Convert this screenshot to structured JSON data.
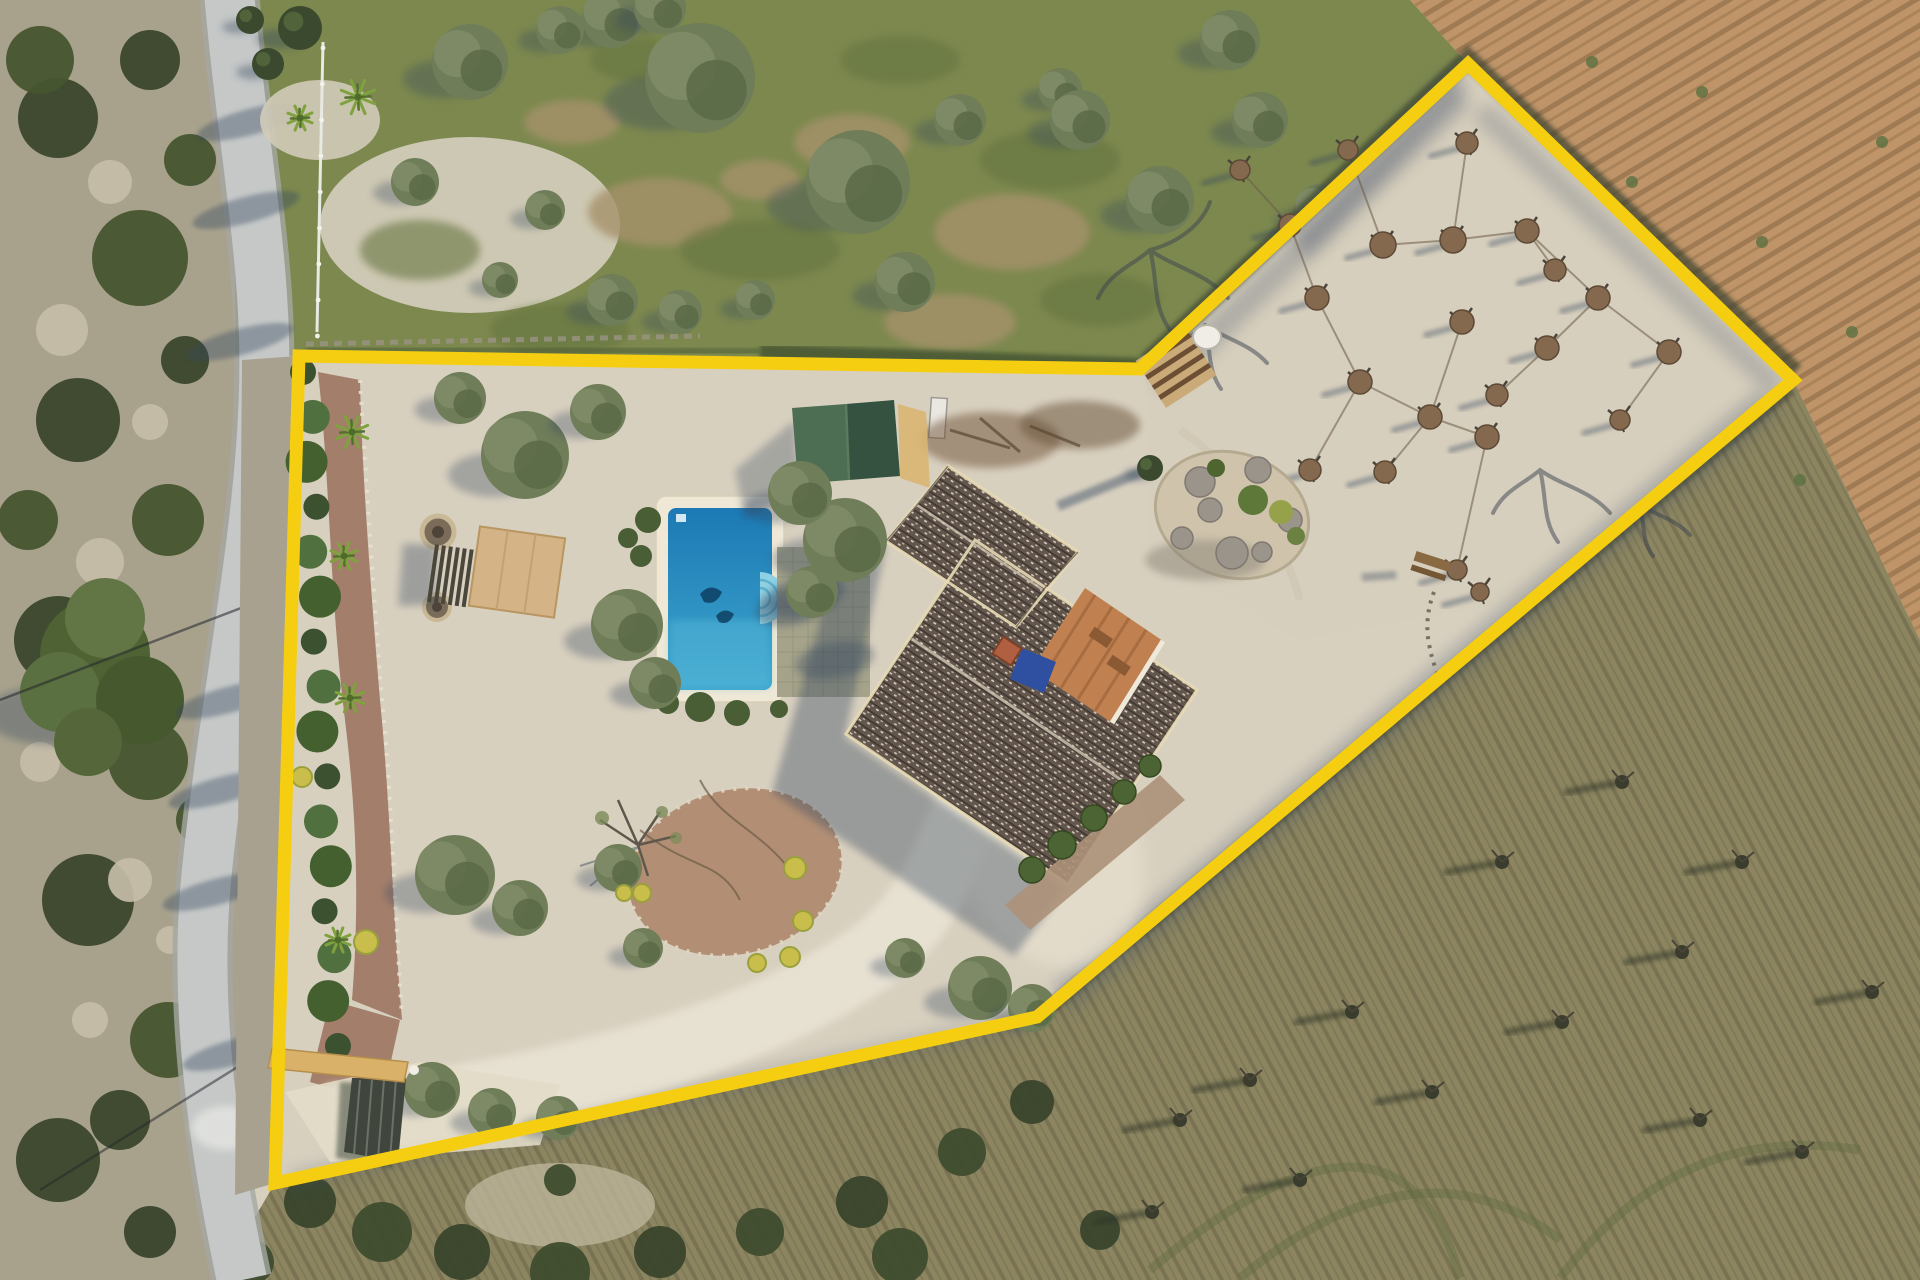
{
  "image": {
    "kind": "aerial-drone-photograph",
    "subject": "country villa plot with yellow property boundary overlay",
    "width": 1920,
    "height": 1280
  },
  "boundary": {
    "points": "299,356 1140,369 1468,64 1793,380 1037,1017 275,1183",
    "color": "#F5CE12",
    "width": 13
  },
  "palette": {
    "gravel": "#D8D0BF",
    "gravel_bright": "#EAE4D5",
    "orchard_ground": "#D7CEBD",
    "green_field": "#7C884E",
    "green_field_dark": "#66743F",
    "plow_base": "#BE9468",
    "plow_furrow": "#8F6B49",
    "scrub_base": "#8C8560",
    "scrub_stripe": "#6F6A4C",
    "hillside": "#A8A28D",
    "road": "#C5C8C7",
    "road_edge": "#A5A8A3",
    "shadow": "#36465E",
    "roof_base": "#63564C",
    "roof_dark": "#3F3730",
    "roof_speckle": "#D8D2C6",
    "fascia": "#E9DCB6",
    "shed_left": "#4E6E54",
    "shed_right": "#35513F",
    "pool_deep": "#1C79B4",
    "pool_light": "#3EA7CE",
    "pool_steps": "#8FD0E2",
    "coping": "#EFE8D6",
    "patio": "#A5A38A",
    "deck_wood": "#D4B387",
    "pergola_slat": "#4B463C",
    "courtyard": "#C08050",
    "tarp_blue": "#2F4FA0",
    "chimney": "#B06040",
    "mulch_path": "#A37E6B",
    "bed_soil": "#B28F74",
    "hedge_dark": "#3C5130",
    "hedge_light": "#517040",
    "olive_mid": "#6F7D59",
    "olive_light": "#7E8C66",
    "olive_dark": "#5A6947",
    "yellow_bush": "#C9BD4C",
    "mound": "#84694E",
    "mound_dark": "#5C4936",
    "gate_tan": "#D9B169",
    "gate_dark": "#40463D",
    "fence_white": "#E9E9E3",
    "rock": "#9A948B",
    "island_base": "#CFC3AC"
  },
  "scene": {
    "orchard": {
      "mounds": [
        [
          1240,
          170,
          10
        ],
        [
          1290,
          225,
          11
        ],
        [
          1317,
          298,
          12
        ],
        [
          1360,
          382,
          12
        ],
        [
          1430,
          417,
          12
        ],
        [
          1487,
          437,
          12
        ],
        [
          1383,
          245,
          13
        ],
        [
          1453,
          240,
          13
        ],
        [
          1527,
          231,
          12
        ],
        [
          1598,
          298,
          12
        ],
        [
          1669,
          352,
          12
        ],
        [
          1467,
          143,
          11
        ],
        [
          1462,
          322,
          12
        ],
        [
          1547,
          348,
          12
        ],
        [
          1497,
          395,
          11
        ],
        [
          1555,
          270,
          11
        ],
        [
          1310,
          470,
          11
        ],
        [
          1385,
          472,
          11
        ],
        [
          1457,
          570,
          10
        ],
        [
          1480,
          592,
          9
        ],
        [
          1348,
          150,
          10
        ],
        [
          1620,
          420,
          10
        ]
      ],
      "links": [
        [
          1240,
          170,
          1290,
          225
        ],
        [
          1290,
          225,
          1317,
          298
        ],
        [
          1317,
          298,
          1360,
          382
        ],
        [
          1360,
          382,
          1430,
          417
        ],
        [
          1430,
          417,
          1487,
          437
        ],
        [
          1383,
          245,
          1453,
          240
        ],
        [
          1453,
          240,
          1527,
          231
        ],
        [
          1527,
          231,
          1598,
          298
        ],
        [
          1598,
          298,
          1669,
          352
        ],
        [
          1467,
          143,
          1453,
          240
        ],
        [
          1462,
          322,
          1430,
          417
        ],
        [
          1547,
          348,
          1598,
          298
        ],
        [
          1497,
          395,
          1547,
          348
        ],
        [
          1555,
          270,
          1527,
          231
        ],
        [
          1310,
          470,
          1360,
          382
        ],
        [
          1385,
          472,
          1430,
          417
        ],
        [
          1348,
          150,
          1383,
          245
        ],
        [
          1620,
          420,
          1669,
          352
        ],
        [
          1457,
          570,
          1487,
          437
        ]
      ]
    },
    "field_trees": [
      [
        700,
        78,
        55
      ],
      [
        858,
        182,
        52
      ],
      [
        905,
        282,
        30
      ],
      [
        612,
        300,
        26
      ],
      [
        680,
        312,
        22
      ],
      [
        755,
        300,
        20
      ],
      [
        470,
        62,
        38
      ],
      [
        415,
        182,
        24
      ],
      [
        960,
        120,
        26
      ],
      [
        1060,
        90,
        22
      ],
      [
        545,
        210,
        20
      ],
      [
        500,
        280,
        18
      ],
      [
        612,
        18,
        30
      ],
      [
        560,
        30,
        24
      ],
      [
        660,
        8,
        26
      ],
      [
        1080,
        120,
        30
      ],
      [
        1160,
        200,
        34
      ],
      [
        1260,
        120,
        28
      ],
      [
        1320,
        210,
        26
      ],
      [
        1230,
        40,
        30
      ]
    ],
    "garden_trees": [
      [
        525,
        455,
        44
      ],
      [
        598,
        412,
        28
      ],
      [
        460,
        398,
        26
      ],
      [
        845,
        540,
        42
      ],
      [
        800,
        493,
        32
      ],
      [
        812,
        592,
        26
      ],
      [
        627,
        625,
        36
      ],
      [
        655,
        683,
        26
      ],
      [
        455,
        875,
        40
      ],
      [
        520,
        908,
        28
      ],
      [
        618,
        868,
        24
      ],
      [
        643,
        948,
        20
      ],
      [
        980,
        988,
        32
      ],
      [
        1032,
        1008,
        24
      ],
      [
        432,
        1090,
        28
      ],
      [
        492,
        1112,
        24
      ],
      [
        558,
        1118,
        22
      ],
      [
        905,
        958,
        20
      ]
    ],
    "cypresses": [
      [
        300,
        28,
        22
      ],
      [
        268,
        64,
        16
      ],
      [
        1150,
        468,
        13
      ],
      [
        250,
        20,
        14
      ]
    ],
    "palms": [
      [
        352,
        432,
        17
      ],
      [
        344,
        556,
        14
      ],
      [
        350,
        698,
        15
      ],
      [
        338,
        940,
        13
      ],
      [
        358,
        97,
        18
      ],
      [
        300,
        118,
        13
      ]
    ],
    "hedge_row": {
      "x1": 303,
      "y1": 372,
      "x2": 330,
      "y2": 1046,
      "count": 16
    },
    "yellow_bushes": [
      [
        795,
        868,
        11
      ],
      [
        803,
        921,
        10
      ],
      [
        790,
        957,
        10
      ],
      [
        757,
        963,
        9
      ],
      [
        642,
        893,
        9
      ],
      [
        366,
        942,
        12
      ],
      [
        302,
        777,
        10
      ],
      [
        624,
        893,
        8
      ]
    ],
    "pool_bushes": [
      [
        648,
        520,
        13
      ],
      [
        641,
        556,
        11
      ],
      [
        700,
        707,
        15
      ],
      [
        737,
        713,
        13
      ],
      [
        668,
        703,
        11
      ],
      [
        779,
        709,
        9
      ],
      [
        628,
        538,
        10
      ]
    ],
    "house_bushes": [
      [
        1032,
        870,
        13
      ],
      [
        1062,
        845,
        14
      ],
      [
        1094,
        818,
        13
      ],
      [
        1124,
        792,
        12
      ],
      [
        1150,
        766,
        11
      ]
    ],
    "island_rocks": [
      [
        1200,
        482,
        15
      ],
      [
        1258,
        470,
        13
      ],
      [
        1290,
        520,
        12
      ],
      [
        1232,
        553,
        16
      ],
      [
        1182,
        538,
        11
      ],
      [
        1262,
        552,
        10
      ],
      [
        1210,
        510,
        12
      ]
    ],
    "island_bushes": [
      [
        1253,
        500,
        15,
        "#5E7839"
      ],
      [
        1281,
        512,
        12,
        "#96A24A"
      ],
      [
        1216,
        468,
        9,
        "#4E6530"
      ],
      [
        1296,
        536,
        9,
        "#6B8142"
      ]
    ],
    "scrub_left": [
      [
        58,
        118,
        40
      ],
      [
        140,
        258,
        48
      ],
      [
        78,
        420,
        42
      ],
      [
        168,
        520,
        36
      ],
      [
        58,
        640,
        44
      ],
      [
        148,
        760,
        40
      ],
      [
        88,
        900,
        46
      ],
      [
        168,
        1040,
        38
      ],
      [
        58,
        1160,
        42
      ],
      [
        28,
        520,
        30
      ],
      [
        120,
        1120,
        30
      ],
      [
        40,
        60,
        34
      ],
      [
        150,
        60,
        30
      ],
      [
        190,
        160,
        26
      ],
      [
        185,
        360,
        24
      ],
      [
        200,
        820,
        24
      ]
    ],
    "rocks_left": [
      [
        110,
        182,
        22
      ],
      [
        62,
        330,
        26
      ],
      [
        150,
        422,
        18
      ],
      [
        100,
        562,
        24
      ],
      [
        40,
        762,
        20
      ],
      [
        130,
        880,
        22
      ],
      [
        90,
        1020,
        18
      ],
      [
        170,
        940,
        14
      ]
    ],
    "scrub_bottom": [
      [
        310,
        1202,
        26
      ],
      [
        382,
        1232,
        30
      ],
      [
        462,
        1252,
        28
      ],
      [
        560,
        1272,
        30
      ],
      [
        660,
        1252,
        26
      ],
      [
        252,
        1262,
        22
      ],
      [
        150,
        1232,
        26
      ],
      [
        760,
        1232,
        24
      ],
      [
        862,
        1202,
        26
      ],
      [
        962,
        1152,
        24
      ],
      [
        1032,
        1102,
        22
      ],
      [
        900,
        1256,
        28
      ],
      [
        1100,
        1230,
        20
      ],
      [
        560,
        1180,
        16
      ]
    ],
    "twig_shrubs": [
      [
        1180,
        1120
      ],
      [
        1300,
        1180
      ],
      [
        1432,
        1092
      ],
      [
        1562,
        1022
      ],
      [
        1682,
        952
      ],
      [
        1742,
        862
      ],
      [
        1622,
        782
      ],
      [
        1502,
        862
      ],
      [
        1352,
        1012
      ],
      [
        1152,
        1212
      ],
      [
        1802,
        1152
      ],
      [
        1872,
        992
      ],
      [
        1250,
        1080
      ],
      [
        1700,
        1120
      ]
    ],
    "weeds": [
      [
        1502,
        122
      ],
      [
        1632,
        182
      ],
      [
        1762,
        242
      ],
      [
        1852,
        332
      ],
      [
        1592,
        62
      ],
      [
        1702,
        92
      ],
      [
        1882,
        142
      ],
      [
        1560,
        390
      ],
      [
        1680,
        440
      ],
      [
        1800,
        480
      ],
      [
        1620,
        250
      ],
      [
        1740,
        340
      ]
    ],
    "dirt_patches": [
      [
        660,
        212,
        72,
        34
      ],
      [
        852,
        142,
        58,
        28
      ],
      [
        1012,
        232,
        78,
        38
      ],
      [
        572,
        122,
        48,
        22
      ],
      [
        950,
        322,
        66,
        28
      ],
      [
        760,
        180,
        40,
        20
      ]
    ],
    "field_texture": [
      [
        420,
        250,
        60,
        30
      ],
      [
        560,
        330,
        70,
        26
      ],
      [
        900,
        60,
        60,
        24
      ],
      [
        1050,
        160,
        70,
        30
      ],
      [
        760,
        250,
        80,
        30
      ],
      [
        640,
        60,
        50,
        22
      ],
      [
        1100,
        300,
        60,
        26
      ]
    ],
    "road_shadows": [
      [
        250,
        122
      ],
      [
        240,
        342
      ],
      [
        228,
        700
      ],
      [
        216,
        892
      ],
      [
        236,
        1052
      ],
      [
        246,
        210
      ],
      [
        222,
        790
      ]
    ],
    "pine_hill": [
      [
        95,
        655,
        55
      ],
      [
        60,
        692,
        40
      ],
      [
        140,
        700,
        44
      ],
      [
        105,
        618,
        40
      ],
      [
        88,
        742,
        34
      ]
    ]
  }
}
